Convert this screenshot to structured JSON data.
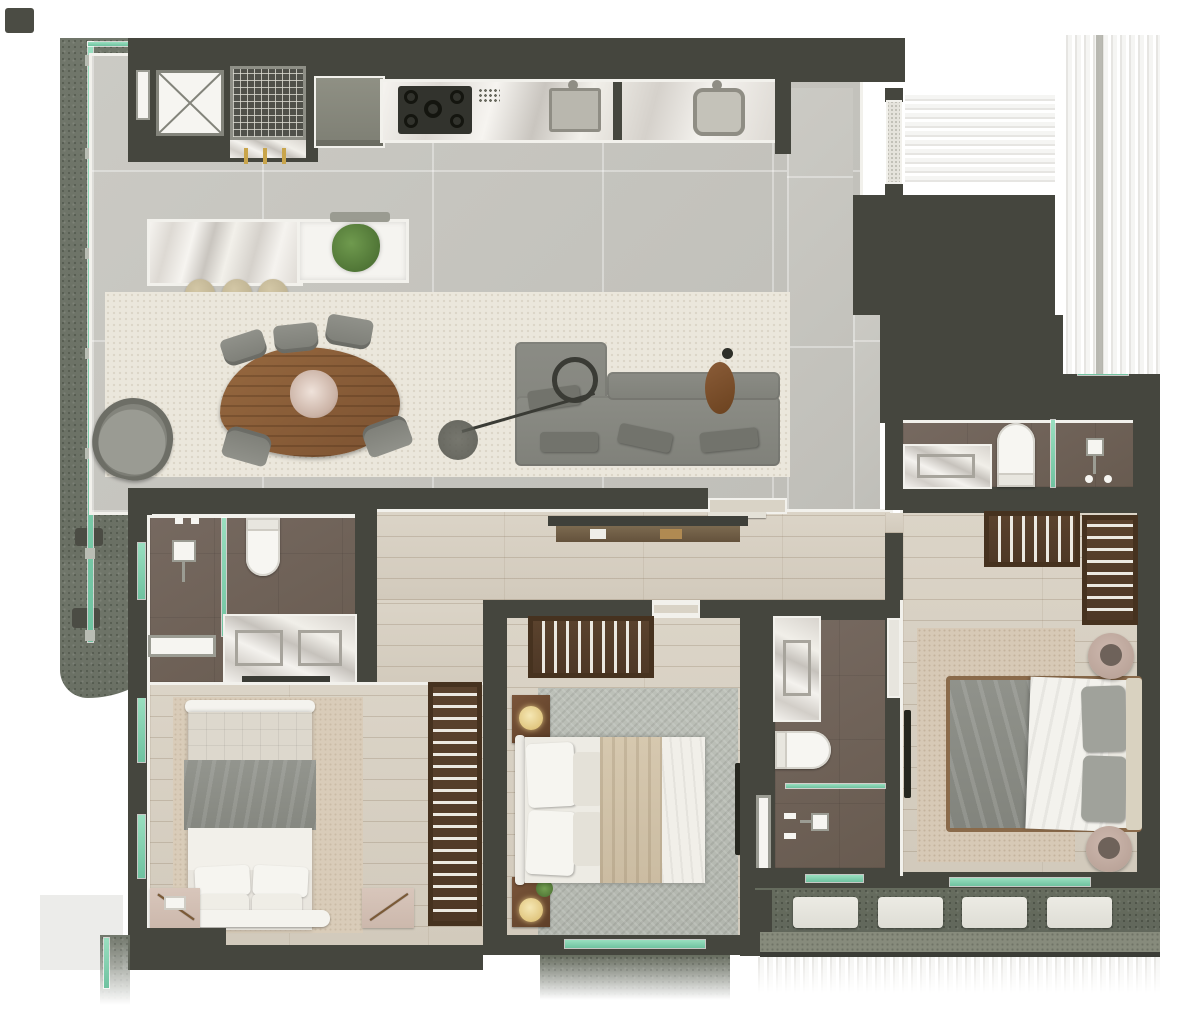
{
  "title": "Top-down 3D rendered floor plan of a 3-bedroom apartment with wrap-around terraces",
  "canvas": {
    "width_px": 1200,
    "height_px": 1010,
    "visible_text": "none"
  },
  "palette": {
    "background": "#ffffff",
    "wall": "#45463e",
    "wall_trim": "#f2f1ec",
    "tile_floor": "#c8c7c1",
    "wood_floor": "#d7d0c3",
    "bathroom_floor": "#6f6257",
    "terrace_floor": "#70766a",
    "balcony_floor": "#666c5e",
    "glass_glazing": "#7fcfae",
    "marble": "#efede8",
    "sofa_gray": "#85867f",
    "dining_table_wood": "#8a5f3d",
    "wardrobe_wood": "#55402c",
    "rug_living": "#ebe7dc",
    "rug_bedroom1": "#d9ccb9",
    "rug_bedroom2": "#b8bcb4",
    "rug_master": "#d7c9b6",
    "linen_white": "#f1efe9",
    "blanket_gray": "#8e908a",
    "throw_beige": "#d3c5ac",
    "lamp_glow": "#e8d79a",
    "accent_gold": "#c9a54b"
  },
  "rooms": [
    {
      "id": "terrace-left",
      "name": "Curved side terrace",
      "features": [
        "glass balustrade",
        "two planter benches",
        "speckled concrete floor"
      ]
    },
    {
      "id": "living-kitchen",
      "name": "Open living / dining / kitchen",
      "features": [
        "linear kitchen counter with 5-burner cooktop and two sinks",
        "barbecue grill niche with 3 skewers",
        "duct shaft marked with X",
        "kitchen island (marble + white) with plant and 3 stools",
        "woven area rug",
        "organic-shaped wood dining table with 5 chairs and flower centerpiece",
        "gray lounge armchair",
        "L-shaped gray sofa with chaise",
        "arc floor lamp",
        "oval wood side table",
        "slim console in hallway"
      ]
    },
    {
      "id": "entry-corridor",
      "name": "Entry vestibule and corridor",
      "features": [
        "entry door on east wall",
        "tiled floor"
      ]
    },
    {
      "id": "hall",
      "name": "Internal hallway",
      "features": [
        "wood plank floor",
        "open door leaf",
        "console table"
      ]
    },
    {
      "id": "bathroom-1",
      "name": "Hall bathroom",
      "features": [
        "walk-in shower with glass screen",
        "toilet",
        "double-sink marble vanity",
        "wall niche",
        "window"
      ]
    },
    {
      "id": "bedroom-1",
      "name": "Bedroom 1 (bottom-left)",
      "features": [
        "double bed with gray wrap blanket",
        "two pink bedside mats with twig decor",
        "beige rug",
        "slatted wood wardrobe",
        "two facade windows"
      ]
    },
    {
      "id": "bedroom-2",
      "name": "Bedroom 2 (bottom-center)",
      "features": [
        "double bed with beige throw",
        "two wood nightstands with glowing lamps",
        "plant",
        "herringbone gray rug",
        "slatted wardrobe",
        "wall TV",
        "window to rear balcony"
      ]
    },
    {
      "id": "ensuite-2",
      "name": "Master ensuite bathroom",
      "features": [
        "marble vanity",
        "toilet",
        "glass-screened shower",
        "wall niche",
        "window"
      ]
    },
    {
      "id": "bathroom-3",
      "name": "Guest bathroom (right)",
      "features": [
        "marble vanity",
        "toilet",
        "glass-screened shower with rain head",
        "clerestory window"
      ]
    },
    {
      "id": "master-bedroom",
      "name": "Master bedroom (bottom-right)",
      "features": [
        "double bed with gray duvet and white sheet",
        "two round dusty-pink side tables",
        "two slatted wardrobes",
        "wall TV",
        "beige rug",
        "window to rear balcony"
      ]
    },
    {
      "id": "balcony-rear",
      "name": "Rear balcony",
      "features": [
        "4 white loungers",
        "speckled stone floor"
      ]
    }
  ],
  "counts": {
    "bedrooms": 3,
    "bathrooms": 3,
    "dining_chairs": 5,
    "island_stools": 3,
    "cooktop_burners": 5,
    "kitchen_sinks": 2,
    "grill_skewers": 3,
    "balcony_loungers": 4,
    "terrace_planters": 2,
    "facade_glass_posts": 7
  },
  "glazing": {
    "color": "#7fcfae",
    "locations": [
      "left facade full-height",
      "bedroom-1 west x2",
      "bedroom-2 south",
      "ensuite-2 south",
      "master south",
      "corridor lightwell",
      "bathroom-1 west"
    ]
  },
  "fade_areas": [
    "top-right horizontal blur band",
    "right vertical blur band (adjacent core)",
    "bottom blur strip under rear balcony",
    "pale block bottom-left"
  ]
}
